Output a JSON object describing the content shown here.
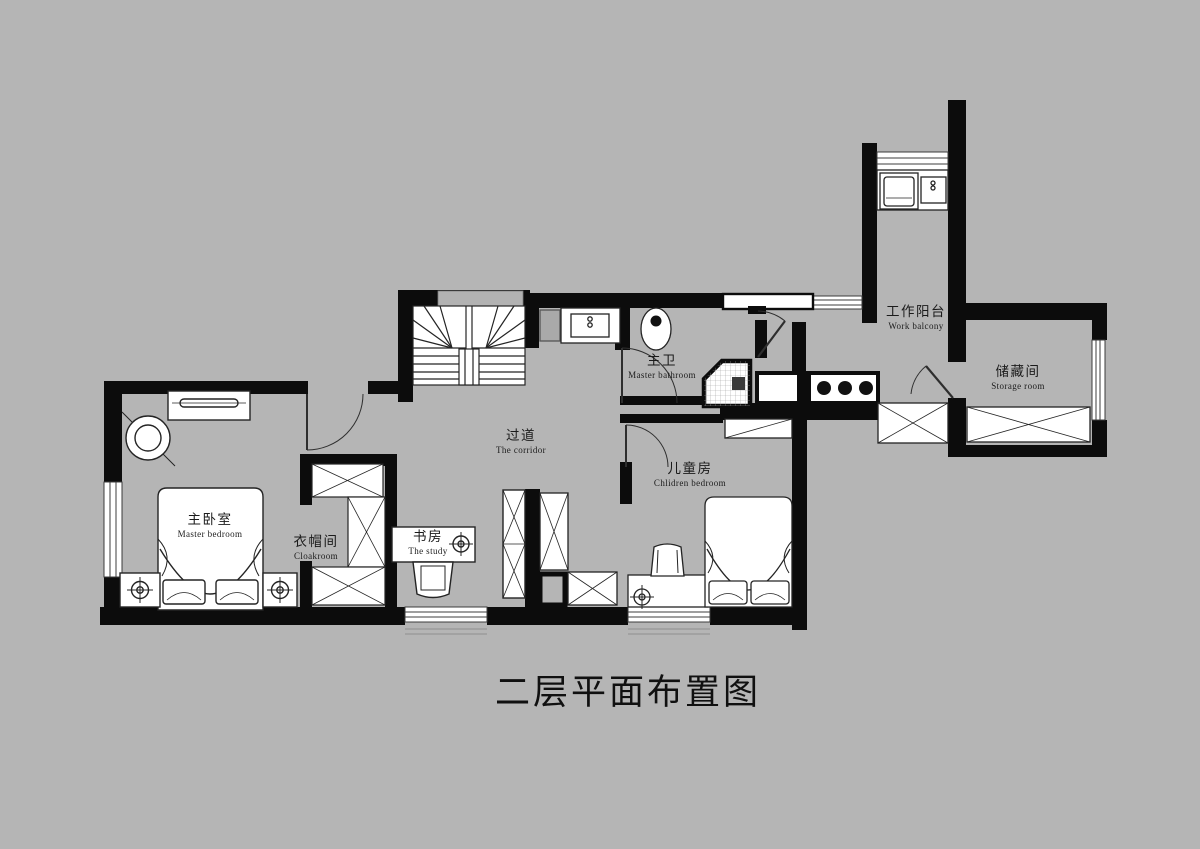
{
  "title": "二层平面布置图",
  "rooms": {
    "master_bedroom": {
      "zh": "主卧室",
      "en": "Master bedroom"
    },
    "cloakroom": {
      "zh": "衣帽间",
      "en": "Cloakroom"
    },
    "study": {
      "zh": "书房",
      "en": "The study"
    },
    "corridor": {
      "zh": "过道",
      "en": "The corridor"
    },
    "master_bathroom": {
      "zh": "主卫",
      "en": "Master bathroom"
    },
    "children_bedroom": {
      "zh": "儿童房",
      "en": "Chlidren bedroom"
    },
    "work_balcony": {
      "zh": "工作阳台",
      "en": "Work balcony"
    },
    "storage_room": {
      "zh": "储藏间",
      "en": "Storage room"
    }
  },
  "colors": {
    "background": "#b5b5b5",
    "wall": "#0c0c0c",
    "furniture_fill": "#ffffff",
    "line": "#242424"
  }
}
